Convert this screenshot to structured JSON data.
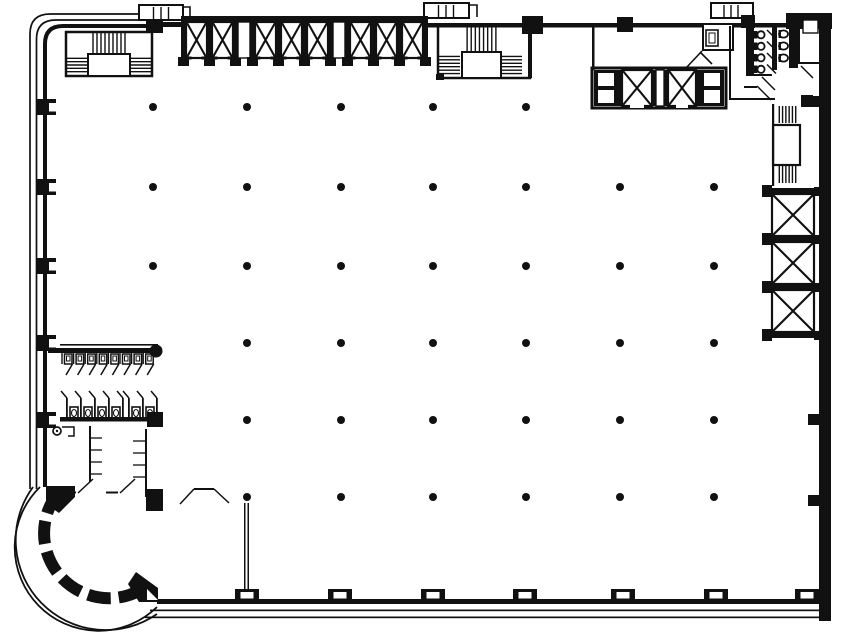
{
  "meta": {
    "title": "Architectural floor plan — office tower typical floor",
    "drawing_type": "black-and-white architectural plan drawing",
    "paper_color": "#ffffff",
    "ink_color": "#111111",
    "element_inventory": {
      "structural_column_dots": 37,
      "elevator_cars_total": 13,
      "stairs": 3,
      "washrooms": 2,
      "curved_rotunda_walls": 1
    }
  },
  "canvas": {
    "width": 846,
    "height": 638
  },
  "column_grid": {
    "cols_x": [
      153,
      247,
      341,
      433,
      526,
      620,
      714
    ],
    "rows_y": [
      107,
      187,
      266,
      343,
      420,
      497
    ],
    "present": [
      [
        0,
        1,
        2,
        3,
        4
      ],
      [
        0,
        1,
        2,
        3,
        4,
        5,
        6
      ],
      [
        0,
        1,
        2,
        3,
        4,
        5,
        6
      ],
      [
        1,
        2,
        3,
        4,
        5,
        6
      ],
      [
        1,
        2,
        3,
        4,
        5,
        6
      ],
      [
        1,
        2,
        3,
        4,
        5,
        6
      ]
    ],
    "dot_radius": 4
  },
  "perimeter": {
    "bottom_mullions_x": [
      247,
      340,
      433,
      525,
      623,
      716,
      807
    ],
    "left_wall_blocks_y": [
      99,
      179,
      258,
      335,
      412
    ],
    "right_wall_bumps_y": [
      96,
      414,
      495
    ]
  },
  "top_elevator_bank": {
    "x": 181,
    "top_bar_y": 16,
    "cell_y": 22,
    "cell_h": 36,
    "car_w": 21,
    "gap_w": 12,
    "post_w": 5,
    "pattern": [
      "car",
      "car",
      "gap",
      "car",
      "car",
      "car",
      "gap",
      "car",
      "car",
      "car"
    ]
  },
  "right_elevator_bank": {
    "x": 772,
    "w": 42,
    "post_ys": [
      188,
      236,
      284,
      332
    ],
    "post_h": 6,
    "car_h": 42
  },
  "service_core": {
    "x": 594,
    "y": 70,
    "h": 36,
    "post_w": 4,
    "cells": [
      {
        "t": "vent",
        "w": 24
      },
      {
        "t": "car",
        "w": 30
      },
      {
        "t": "gap",
        "w": 8
      },
      {
        "t": "car",
        "w": 28
      },
      {
        "t": "vent",
        "w": 24
      }
    ]
  },
  "washrooms": {
    "southwest": {
      "stall_row": {
        "count": 8,
        "start_x": 63,
        "pitch": 11.6,
        "y": 353
      },
      "urinal_groups": [
        {
          "start_x": 66,
          "count": 4,
          "pitch": 14,
          "y": 398
        },
        {
          "start_x": 128,
          "count": 2,
          "pitch": 14,
          "y": 398
        }
      ],
      "lavatory_tick_rows": 2
    },
    "northeast": {
      "toilets": {
        "count": 4,
        "start_y": 30,
        "pitch": 11.5,
        "x": 753
      },
      "wall_fixtures": {
        "count": 3,
        "start_y": 34,
        "pitch": 12,
        "x": 783
      }
    }
  },
  "stair_treads": [
    {
      "x": 89,
      "y": 33,
      "w": 40,
      "h": 21,
      "dir": "v",
      "n": 9
    },
    {
      "x": 67,
      "y": 55,
      "w": 20,
      "h": 20,
      "dir": "h",
      "n": 5
    },
    {
      "x": 131,
      "y": 55,
      "w": 20,
      "h": 20,
      "dir": "h",
      "n": 5
    },
    {
      "x": 463,
      "y": 27,
      "w": 37,
      "h": 24,
      "dir": "v",
      "n": 8
    },
    {
      "x": 439,
      "y": 53,
      "w": 21,
      "h": 24,
      "dir": "h",
      "n": 6
    },
    {
      "x": 502,
      "y": 53,
      "w": 20,
      "h": 24,
      "dir": "h",
      "n": 6
    },
    {
      "x": 146,
      "y": 7,
      "w": 30,
      "h": 12,
      "dir": "v",
      "n": 3
    },
    {
      "x": 431,
      "y": 5,
      "w": 30,
      "h": 12,
      "dir": "v",
      "n": 3
    },
    {
      "x": 717,
      "y": 5,
      "w": 28,
      "h": 12,
      "dir": "v",
      "n": 3
    },
    {
      "x": 776,
      "y": 106,
      "w": 23,
      "h": 17,
      "dir": "v",
      "n": 6
    },
    {
      "x": 776,
      "y": 166,
      "w": 23,
      "h": 17,
      "dir": "v",
      "n": 6
    }
  ]
}
